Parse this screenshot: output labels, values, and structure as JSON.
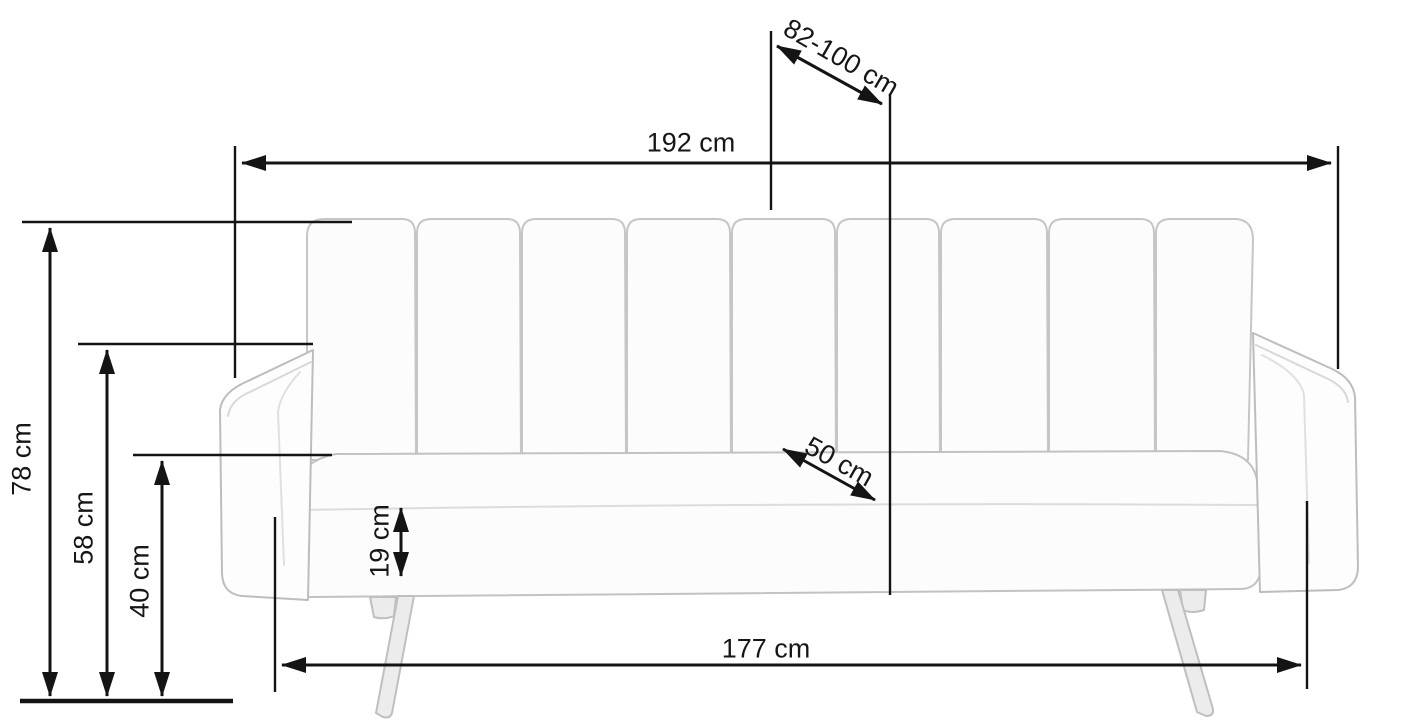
{
  "diagram": {
    "type": "furniture-dimension-drawing",
    "subject": "sofa-bed-front-view",
    "unit": "cm",
    "labels": {
      "overall_width": "192 cm",
      "unfolded_depth_range": "82-100 cm",
      "overall_height": "78 cm",
      "arm_height": "58 cm",
      "seat_height": "40 cm",
      "cushion_thickness": "19 cm",
      "seat_depth": "50 cm",
      "base_width": "177 cm"
    },
    "colors": {
      "background": "#ffffff",
      "dimension_line": "#141414",
      "sofa_outline": "#c2c2c2",
      "sofa_fill": "#fcfcfc",
      "sofa_seam": "#d8d8d8",
      "leg_fill": "#ececec"
    }
  }
}
